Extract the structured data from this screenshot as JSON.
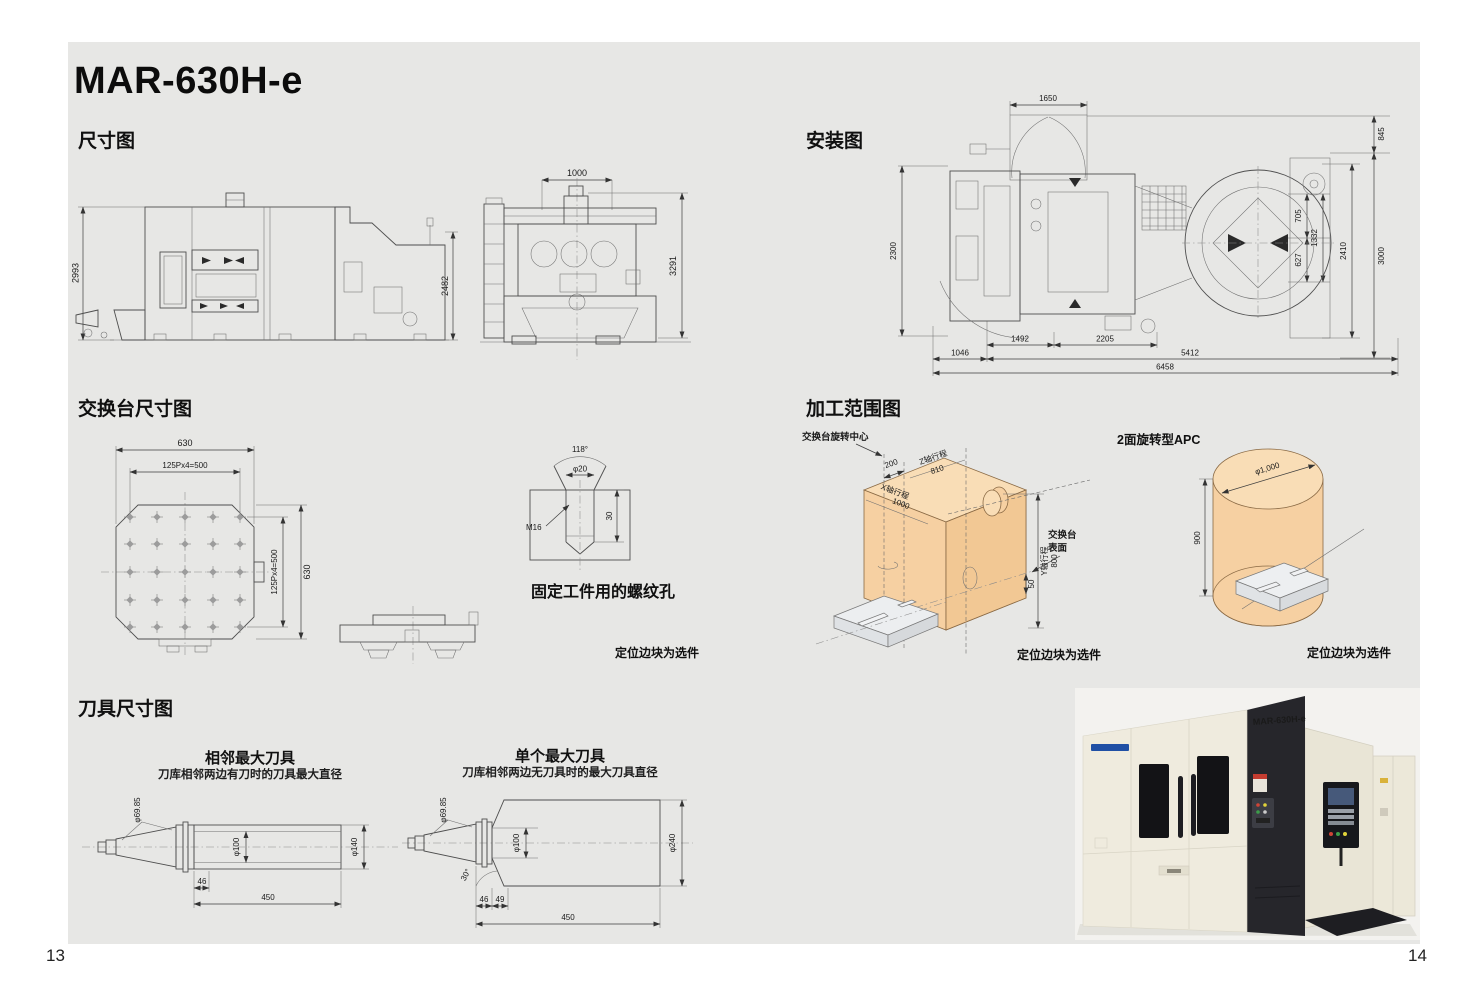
{
  "page": {
    "title": "MAR-630H-e",
    "page_left": "13",
    "page_right": "14"
  },
  "headings": {
    "dimensions": "尺寸图",
    "installation": "安装图",
    "pallet": "交换台尺寸图",
    "range": "加工范围图",
    "tools": "刀具尺寸图"
  },
  "dim_diagram": {
    "side_left_height": "2993",
    "side_right_height": "2482",
    "front_top_width": "1000",
    "front_right_height": "3291"
  },
  "install_diagram": {
    "top_width": "1650",
    "right_top": "845",
    "inner_top": "705",
    "inner_bottom": "627",
    "inner_total": "1332",
    "right_inner": "2410",
    "right_outer": "3000",
    "left_height": "2300",
    "bottom_inner_left": "1492",
    "bottom_inner_right": "2205",
    "bottom_left": "1046",
    "bottom_mid": "5412",
    "bottom_total": "6458"
  },
  "pallet_diagram": {
    "top_width": "630",
    "top_pitch": "125Px4=500",
    "right_pitch": "125Px4=500",
    "right_height": "630"
  },
  "screw_detail": {
    "angle": "118°",
    "diameter": "φ20",
    "depth": "30",
    "thread": "M16",
    "caption": "固定工件用的螺纹孔"
  },
  "optional_note": "定位边块为选件",
  "range_diagram": {
    "rotation_center": "交换台旋转中心",
    "offset": "200",
    "z_label": "Z轴行程",
    "z_value": "810",
    "x_label": "X轴行程",
    "x_value": "1000",
    "y_label": "Y轴行程",
    "y_value": "800",
    "surface_line1": "交换台",
    "surface_line2": "表面",
    "surface_offset": "50"
  },
  "apc": {
    "label": "2面旋转型APC",
    "diameter": "φ1,000",
    "height": "900"
  },
  "tools": {
    "tool1": {
      "title": "相邻最大刀具",
      "subtitle": "刀库相邻两边有刀时的刀具最大直径",
      "taper_dia": "φ69.85",
      "core_dia": "φ100",
      "outer_dia": "φ140",
      "len_flange": "46",
      "len_total": "450"
    },
    "tool2": {
      "title": "单个最大刀具",
      "subtitle": "刀库相邻两边无刀具时的最大刀具直径",
      "taper_dia": "φ69.85",
      "core_dia": "φ100",
      "outer_dia": "φ240",
      "angle": "30°",
      "len_flange": "46",
      "len_step": "49",
      "len_total": "450"
    }
  },
  "photo": {
    "model_label": "MAR-630H-e"
  }
}
